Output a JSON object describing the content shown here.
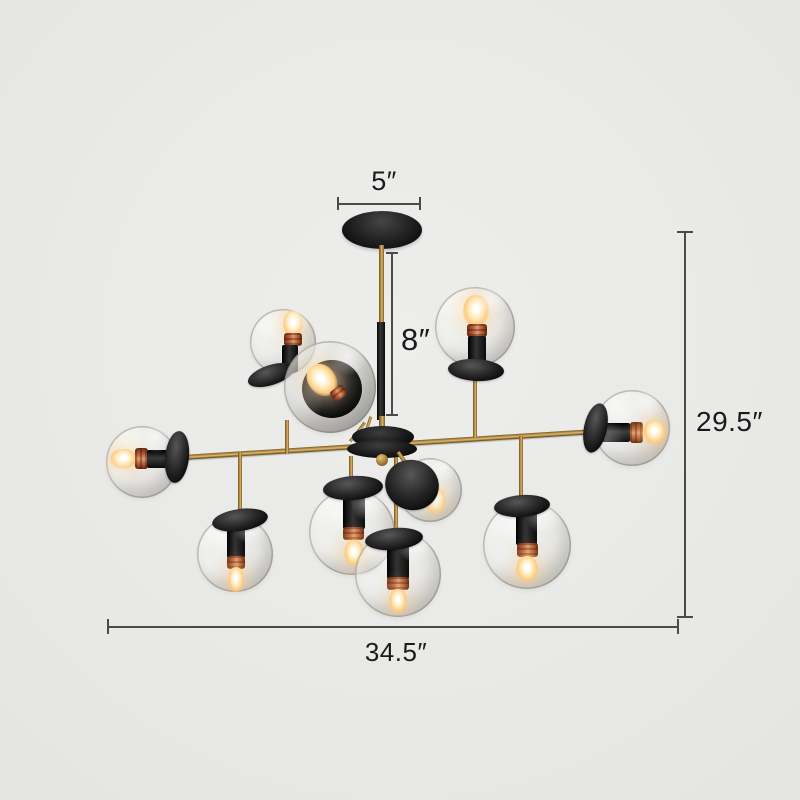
{
  "scene": {
    "type": "product dimension photo",
    "subject": "10-light modern chandelier with clear glass globe shades, brass arms, black canopy and sockets",
    "globe_count": 10,
    "background_color": "#e9e9e7"
  },
  "annotations": {
    "canopy_width_label": "5″",
    "rod_drop_label": "8″",
    "overall_height_label": "29.5″",
    "overall_width_label": "34.5″"
  },
  "colors": {
    "dimension_line": "#4a4a4a",
    "dimension_text": "#1b1b1b",
    "brass": "#b88f46",
    "black_metal": "#1c1c1c",
    "copper_band": "#b4603a",
    "bulb_glow": "#ffdca4",
    "glass_edge": "#6c6a62"
  }
}
